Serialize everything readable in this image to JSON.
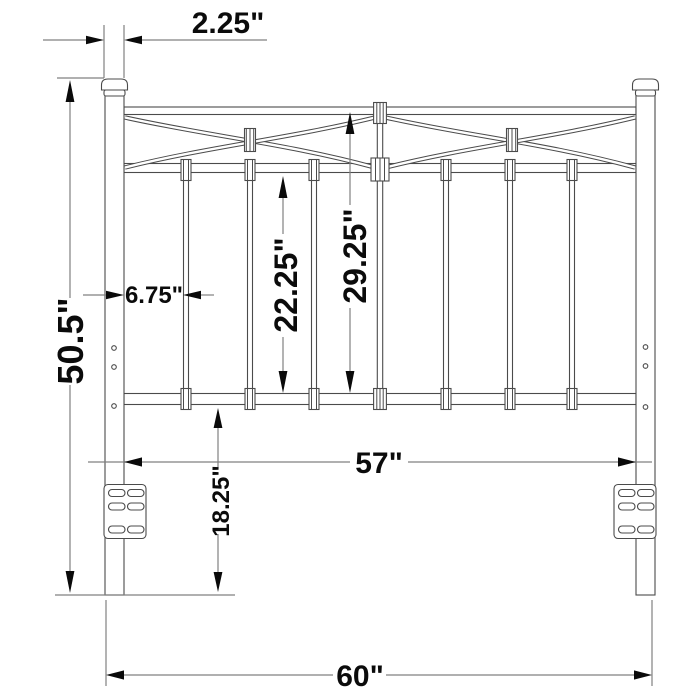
{
  "figure": {
    "title": "Headboard dimensioned line drawing",
    "view": "front elevation"
  },
  "dimensions": {
    "post_width": "2.25\"",
    "overall_height": "50.5\"",
    "post_to_first_spindle": "6.75\"",
    "spindle_section_height": "22.25\"",
    "grill_height": "29.25\"",
    "inner_width": "57\"",
    "rail_to_floor": "18.25\"",
    "overall_width": "60\""
  },
  "colors": {
    "background": "#ffffff",
    "drawing_line": "#4b4b4b",
    "dimension_line": "#808080",
    "arrowhead": "#0a0a0a",
    "label_text": "#0b0b0b"
  }
}
